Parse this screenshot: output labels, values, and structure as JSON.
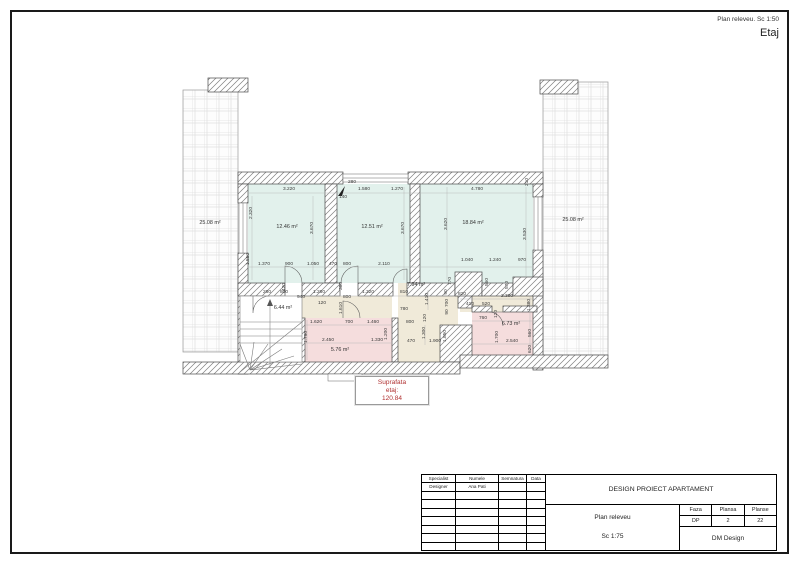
{
  "header": {
    "note": "Plan releveu. Sc 1:50",
    "title": "Etaj"
  },
  "area_box": {
    "line1": "Suprafata",
    "line2": "etaj:",
    "line3": "120.84",
    "color": "#b03030"
  },
  "plan": {
    "room_labels": [
      {
        "t": "12.46 m²",
        "x": 287,
        "y": 228,
        "r": 0
      },
      {
        "t": "12.51 m²",
        "x": 372,
        "y": 228,
        "r": 0
      },
      {
        "t": "18.84 m²",
        "x": 473,
        "y": 224,
        "r": 0
      },
      {
        "t": "25.08 m²",
        "x": 210,
        "y": 224,
        "r": 0
      },
      {
        "t": "25.08 m²",
        "x": 573,
        "y": 221,
        "r": 0
      },
      {
        "t": "6.44 m²",
        "x": 283,
        "y": 309,
        "r": 0
      },
      {
        "t": "7.94 m²",
        "x": 416,
        "y": 286,
        "r": 0
      },
      {
        "t": "5.76 m²",
        "x": 340,
        "y": 351,
        "r": 0
      },
      {
        "t": "6.73 m²",
        "x": 511,
        "y": 325,
        "r": 0
      }
    ],
    "dimensions": [
      {
        "t": "3.220",
        "x": 289,
        "y": 190,
        "r": 0
      },
      {
        "t": "2.320",
        "x": 252,
        "y": 213,
        "r": 1
      },
      {
        "t": "3.670",
        "x": 313,
        "y": 228,
        "r": 1
      },
      {
        "t": "280",
        "x": 352,
        "y": 183,
        "r": 0
      },
      {
        "t": "1.580",
        "x": 364,
        "y": 190,
        "r": 0
      },
      {
        "t": "140",
        "x": 343,
        "y": 198,
        "r": 0
      },
      {
        "t": "1.270",
        "x": 397,
        "y": 190,
        "r": 0
      },
      {
        "t": "3.670",
        "x": 404,
        "y": 228,
        "r": 1
      },
      {
        "t": "3.620",
        "x": 447,
        "y": 224,
        "r": 1
      },
      {
        "t": "4.780",
        "x": 477,
        "y": 190,
        "r": 0
      },
      {
        "t": "210",
        "x": 528,
        "y": 182,
        "r": 1
      },
      {
        "t": "3.530",
        "x": 526,
        "y": 234,
        "r": 1
      },
      {
        "t": "1.550",
        "x": 249,
        "y": 259,
        "r": 1
      },
      {
        "t": "1.370",
        "x": 264,
        "y": 265,
        "r": 0
      },
      {
        "t": "900",
        "x": 289,
        "y": 265,
        "r": 0
      },
      {
        "t": "1.050",
        "x": 313,
        "y": 265,
        "r": 0
      },
      {
        "t": "470",
        "x": 333,
        "y": 265,
        "r": 0
      },
      {
        "t": "800",
        "x": 347,
        "y": 265,
        "r": 0
      },
      {
        "t": "2.110",
        "x": 384,
        "y": 265,
        "r": 0
      },
      {
        "t": "1.040",
        "x": 467,
        "y": 261,
        "r": 0
      },
      {
        "t": "1.240",
        "x": 495,
        "y": 261,
        "r": 0
      },
      {
        "t": "970",
        "x": 522,
        "y": 261,
        "r": 0
      },
      {
        "t": "420",
        "x": 285,
        "y": 287,
        "r": 1
      },
      {
        "t": "260",
        "x": 267,
        "y": 293,
        "r": 0
      },
      {
        "t": "800",
        "x": 284,
        "y": 293,
        "r": 0
      },
      {
        "t": "940",
        "x": 301,
        "y": 298,
        "r": 0
      },
      {
        "t": "1.260",
        "x": 319,
        "y": 293,
        "r": 0
      },
      {
        "t": "120",
        "x": 322,
        "y": 304,
        "r": 0
      },
      {
        "t": "360",
        "x": 342,
        "y": 286,
        "r": 1
      },
      {
        "t": "800",
        "x": 347,
        "y": 298,
        "r": 0
      },
      {
        "t": "1.320",
        "x": 368,
        "y": 293,
        "r": 0
      },
      {
        "t": "810",
        "x": 404,
        "y": 293,
        "r": 0
      },
      {
        "t": "1.620",
        "x": 316,
        "y": 323,
        "r": 0
      },
      {
        "t": "700",
        "x": 349,
        "y": 323,
        "r": 0
      },
      {
        "t": "1.460",
        "x": 373,
        "y": 323,
        "r": 0
      },
      {
        "t": "1.790",
        "x": 307,
        "y": 337,
        "r": 1
      },
      {
        "t": "2.450",
        "x": 328,
        "y": 341,
        "r": 0
      },
      {
        "t": "1.330",
        "x": 377,
        "y": 341,
        "r": 0
      },
      {
        "t": "1.200",
        "x": 387,
        "y": 334,
        "r": 1
      },
      {
        "t": "1.610",
        "x": 342,
        "y": 308,
        "r": 1
      },
      {
        "t": "1.410",
        "x": 428,
        "y": 299,
        "r": 1
      },
      {
        "t": "780",
        "x": 404,
        "y": 310,
        "r": 0
      },
      {
        "t": "800",
        "x": 410,
        "y": 323,
        "r": 0
      },
      {
        "t": "120",
        "x": 426,
        "y": 318,
        "r": 1
      },
      {
        "t": "1.300",
        "x": 425,
        "y": 333,
        "r": 1
      },
      {
        "t": "470",
        "x": 411,
        "y": 342,
        "r": 0
      },
      {
        "t": "1.900",
        "x": 435,
        "y": 342,
        "r": 0
      },
      {
        "t": "1.850",
        "x": 446,
        "y": 336,
        "r": 1
      },
      {
        "t": "90",
        "x": 447,
        "y": 292,
        "r": 1
      },
      {
        "t": "700",
        "x": 448,
        "y": 303,
        "r": 1
      },
      {
        "t": "90",
        "x": 448,
        "y": 312,
        "r": 1
      },
      {
        "t": "770",
        "x": 451,
        "y": 281,
        "r": 1
      },
      {
        "t": "560",
        "x": 488,
        "y": 282,
        "r": 1
      },
      {
        "t": "570",
        "x": 508,
        "y": 285,
        "r": 1
      },
      {
        "t": "820",
        "x": 462,
        "y": 295,
        "r": 0
      },
      {
        "t": "410",
        "x": 470,
        "y": 305,
        "r": 0
      },
      {
        "t": "520",
        "x": 486,
        "y": 305,
        "r": 0
      },
      {
        "t": "2.300",
        "x": 507,
        "y": 297,
        "r": 0
      },
      {
        "t": "760",
        "x": 483,
        "y": 319,
        "r": 0
      },
      {
        "t": "1.380",
        "x": 530,
        "y": 305,
        "r": 1
      },
      {
        "t": "560",
        "x": 531,
        "y": 333,
        "r": 1
      },
      {
        "t": "1.700",
        "x": 498,
        "y": 337,
        "r": 1
      },
      {
        "t": "2.540",
        "x": 512,
        "y": 342,
        "r": 0
      },
      {
        "t": "620",
        "x": 531,
        "y": 349,
        "r": 1
      },
      {
        "t": "120",
        "x": 497,
        "y": 314,
        "r": 1
      }
    ],
    "colors": {
      "room_cyan": "#e2f1ec",
      "room_beige": "#f0ead9",
      "room_pink": "#f5dddd"
    }
  },
  "title_block": {
    "project": "DESIGN PROIECT APARTAMENT",
    "drawing": "Plan releveu",
    "scale": "Sc 1:75",
    "company": "DM Design",
    "faza_label": "Faza",
    "plansa_label": "Plansa",
    "planse_label": "Planse",
    "faza": "DP",
    "plansa": "2",
    "planse": "22",
    "sign_headers": [
      "Specialist",
      "Numele",
      "Semnatura",
      "Data"
    ],
    "sign_rows": [
      [
        "Designer",
        "Ana Pati",
        "",
        ""
      ],
      [
        "",
        "",
        "",
        ""
      ],
      [
        "",
        "",
        "",
        ""
      ],
      [
        "",
        "",
        "",
        ""
      ],
      [
        "",
        "",
        "",
        ""
      ],
      [
        "",
        "",
        "",
        ""
      ],
      [
        "",
        "",
        "",
        ""
      ],
      [
        "",
        "",
        "",
        ""
      ]
    ]
  }
}
